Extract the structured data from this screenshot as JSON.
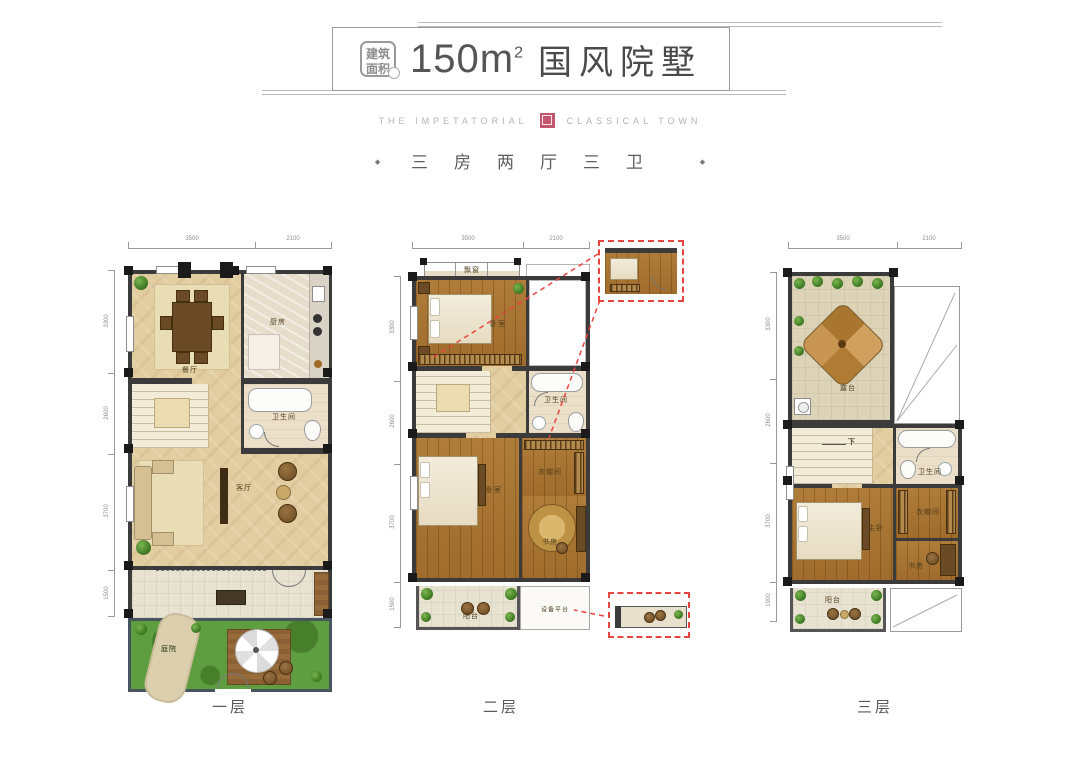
{
  "header": {
    "badge": {
      "line1": "建筑",
      "line2": "面积"
    },
    "area": "150m",
    "area_sup": "2",
    "title": "国风院墅"
  },
  "brand": {
    "left": "THE IMPETATORIAL",
    "right": "CLASSICAL TOWN"
  },
  "spec": {
    "bullet": "◆",
    "text": "三房两厅三卫"
  },
  "floors": [
    {
      "name": "一层",
      "dims_top": [
        "3500",
        "2100"
      ],
      "dims_left": [
        "3300",
        "2600",
        "3700",
        "1500"
      ],
      "rooms": {
        "dining": "餐厅",
        "kitchen": "厨房",
        "bath": "卫生间",
        "living": "客厅",
        "garden": "庭院"
      }
    },
    {
      "name": "二层",
      "dims_top": [
        "3500",
        "2100"
      ],
      "dims_left": [
        "3300",
        "2600",
        "3700",
        "1500"
      ],
      "rooms": {
        "bay": "飘窗",
        "bedroom1": "卧室",
        "bath": "卫生间",
        "bedroom2": "卧室",
        "closet": "衣帽间",
        "study": "书房",
        "balcony": "阳台",
        "equipment": "设备平台"
      }
    },
    {
      "name": "三层",
      "dims_top": [
        "3500",
        "2100"
      ],
      "dims_left": [
        "3300",
        "2600",
        "3700",
        "1900"
      ],
      "rooms": {
        "terrace": "露台",
        "down": "下",
        "bath": "卫生间",
        "master": "主卧",
        "closet": "衣帽间",
        "study": "书房",
        "balcony": "阳台"
      }
    }
  ],
  "colors": {
    "accent_red": "#e8453f",
    "seal_pink": "#c2566f",
    "wood": "#a9752f",
    "tile_tan": "#e2cda0",
    "grass": "#5e9e41"
  }
}
